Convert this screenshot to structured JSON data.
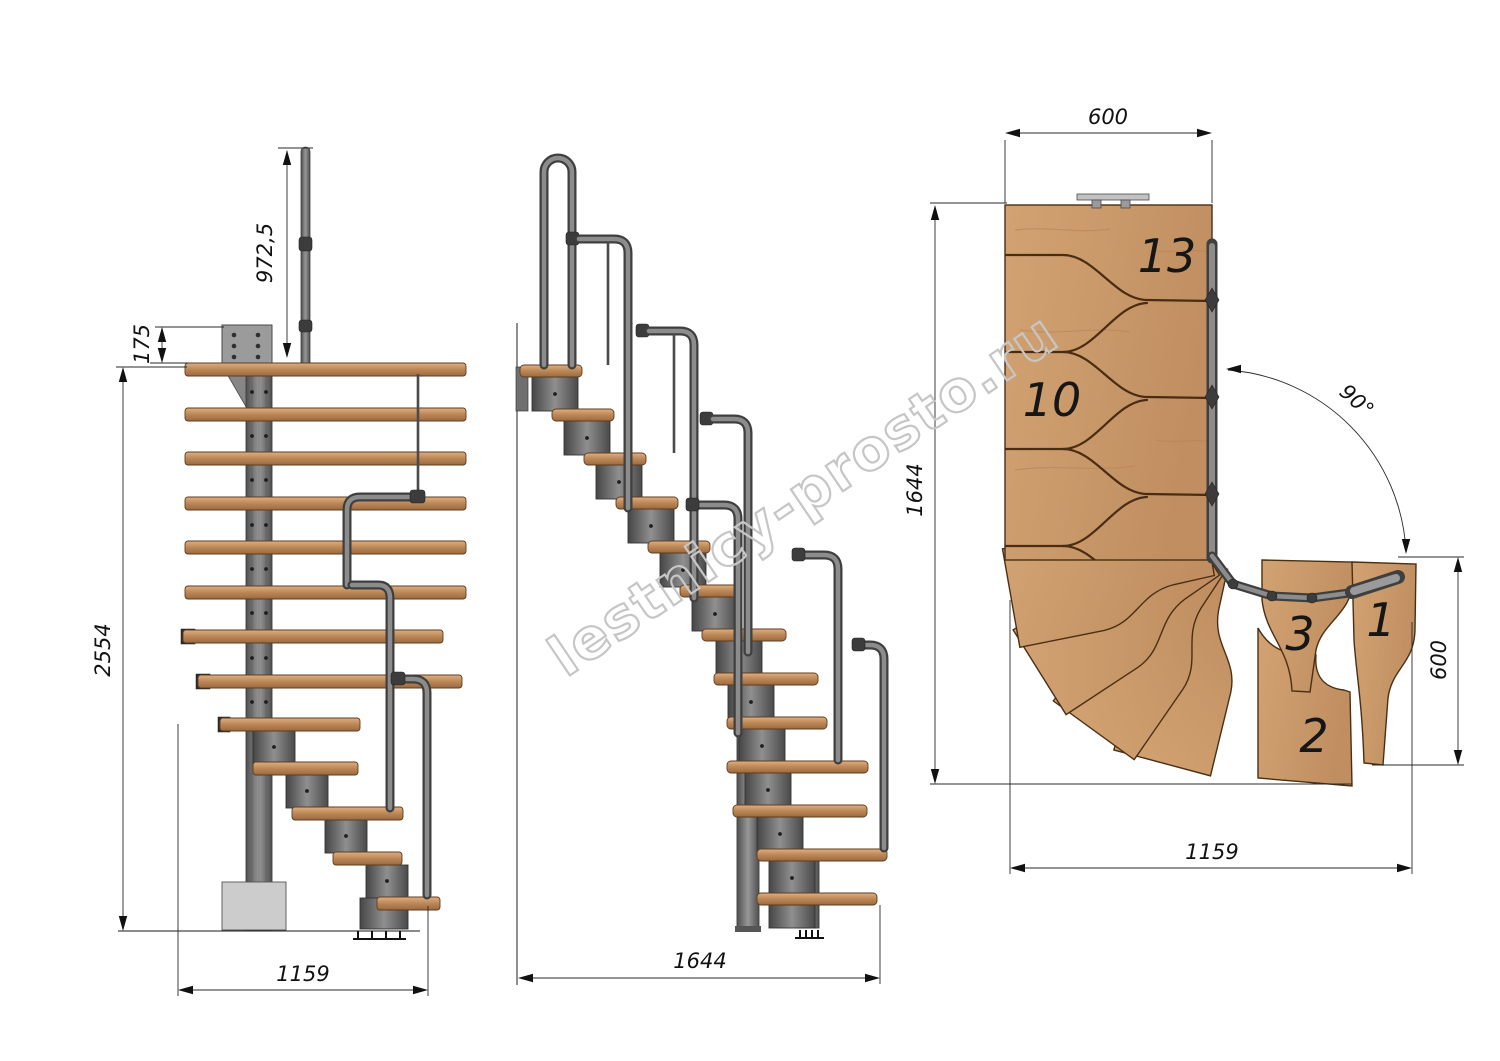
{
  "watermark": {
    "text": "lestnicy-prosto.ru"
  },
  "views": {
    "front": {
      "label": "front-elevation",
      "dims": {
        "handrail_height": "972,5",
        "plate_offset": "175",
        "total_height": "2554",
        "base_width": "1159"
      }
    },
    "side": {
      "label": "side-elevation",
      "dims": {
        "base_length": "1644"
      }
    },
    "plan": {
      "label": "plan-view",
      "dims": {
        "top_width": "600",
        "left_depth": "1644",
        "turn_angle": "90°",
        "right_width": "600",
        "bottom_width": "1159"
      },
      "tread_labels": [
        "13",
        "10",
        "3",
        "1",
        "2"
      ]
    }
  },
  "colors": {
    "wood": "#c1905f",
    "wood_light": "#d8ac7c",
    "metal": "#7a7a7a",
    "metal_dark": "#474747",
    "line": "#1a1a1a",
    "watermark": "#c6c6c6"
  }
}
